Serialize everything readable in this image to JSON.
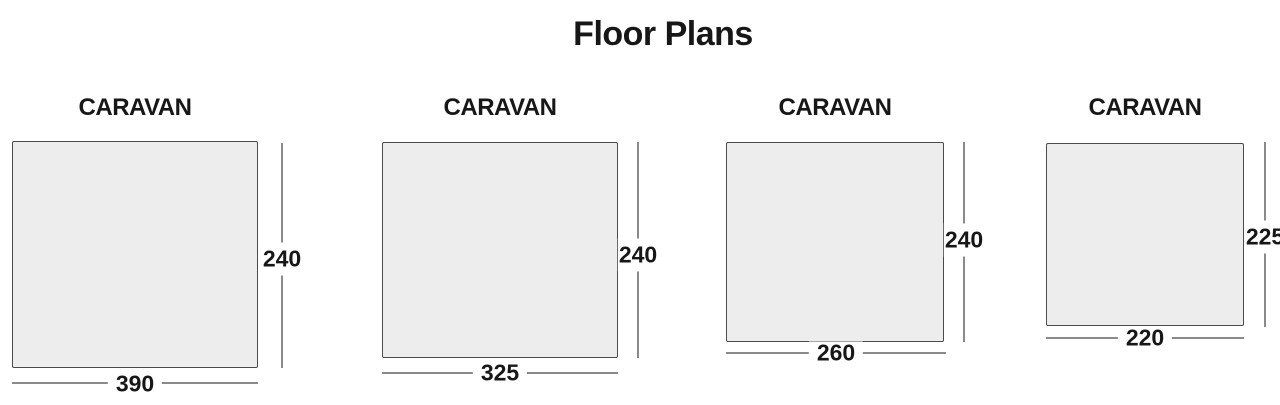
{
  "title": "Floor Plans",
  "plans": [
    {
      "label": "CARAVAN",
      "width": "390",
      "height": "240"
    },
    {
      "label": "CARAVAN",
      "width": "325",
      "height": "240"
    },
    {
      "label": "CARAVAN",
      "width": "260",
      "height": "240"
    },
    {
      "label": "CARAVAN",
      "width": "220",
      "height": "225"
    }
  ],
  "colors": {
    "rect-fill": "#ededed",
    "rect-border": "#4b4b4b",
    "dimension-line": "#8a8a8a",
    "text": "#171717",
    "background": "#ffffff"
  }
}
